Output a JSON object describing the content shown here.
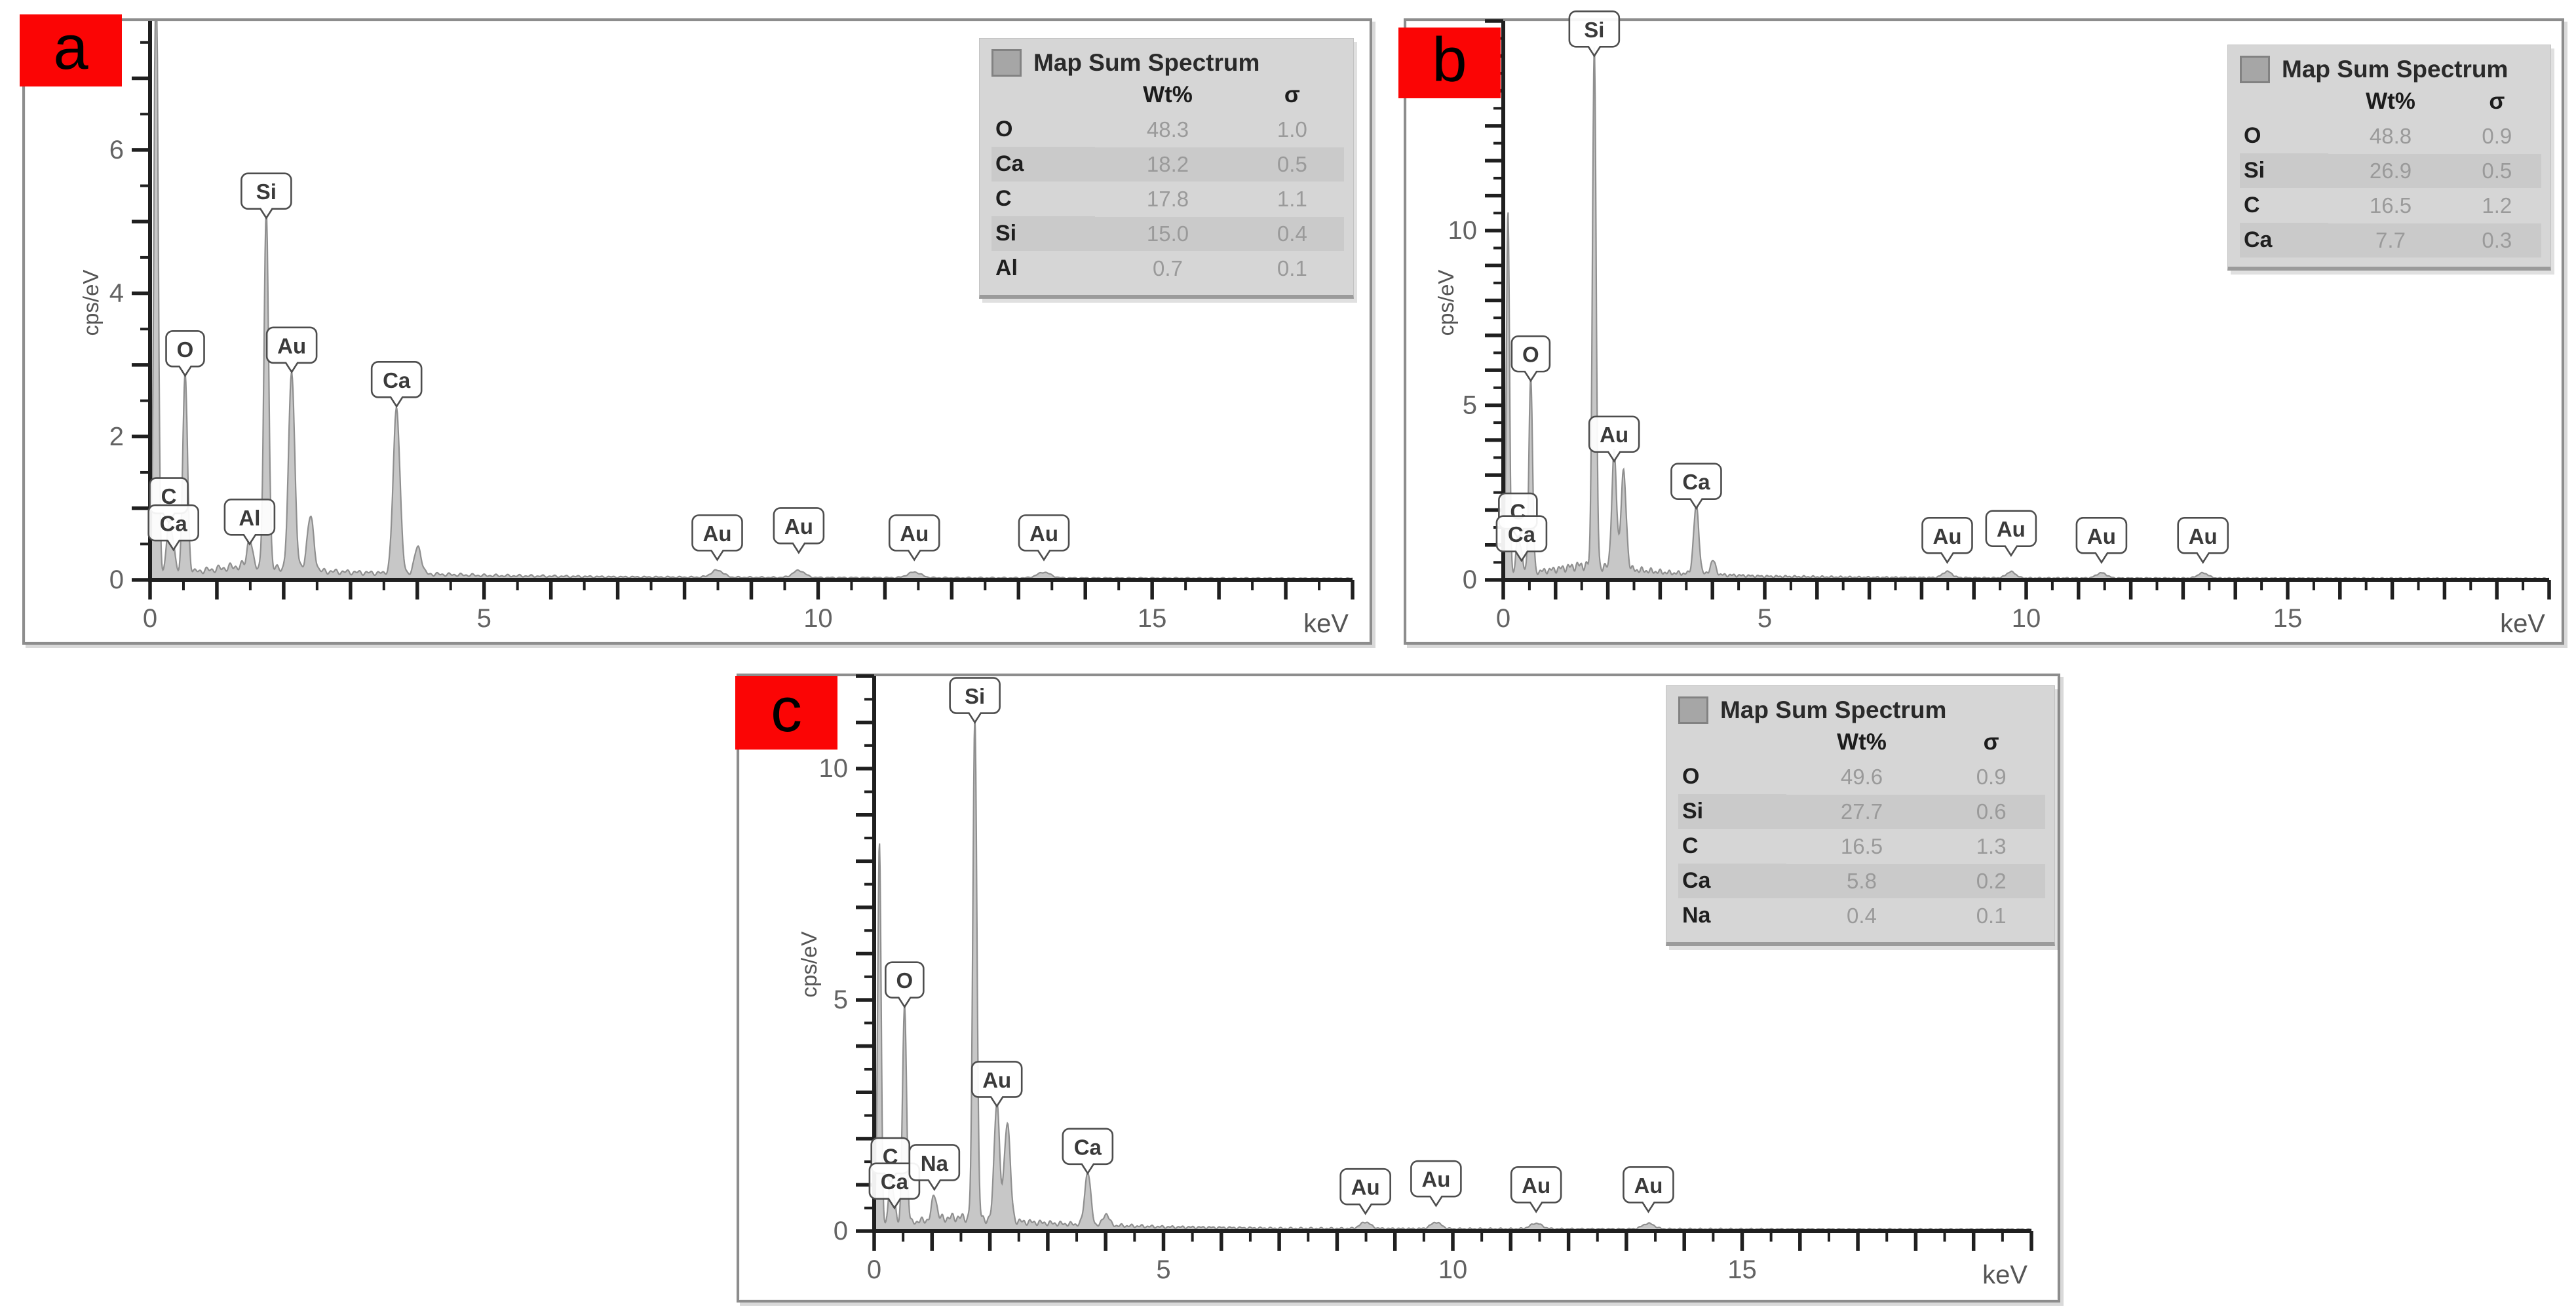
{
  "figure": {
    "badge_color": "#fb0505",
    "panel_border_color": "#8d8d8d",
    "spectrum_fill": "#c7c7c7",
    "spectrum_stroke": "#8f8f8f",
    "axis_color": "#1f1f1f",
    "legend_bg": "#d6d6d6"
  },
  "chart_data": [
    {
      "type": "area",
      "panel_label": "a",
      "xlabel": "keV",
      "ylabel": "cps/eV",
      "xlim": [
        0,
        18
      ],
      "ylim": [
        0,
        7.8
      ],
      "x_major_labels": [
        0,
        5,
        10,
        15
      ],
      "y_major_labels": [
        0,
        2,
        4,
        6
      ],
      "minor_step": 0.5,
      "grid": false,
      "legend_position": "top-right",
      "legend": {
        "title": "Map Sum Spectrum",
        "columns": [
          "Wt%",
          "σ"
        ],
        "rows": [
          {
            "element": "O",
            "wt": "48.3",
            "sigma": "1.0"
          },
          {
            "element": "Ca",
            "wt": "18.2",
            "sigma": "0.5"
          },
          {
            "element": "C",
            "wt": "17.8",
            "sigma": "1.1"
          },
          {
            "element": "Si",
            "wt": "15.0",
            "sigma": "0.4"
          },
          {
            "element": "Al",
            "wt": "0.7",
            "sigma": "0.1"
          }
        ]
      },
      "peaks": [
        {
          "element": "zero-peak",
          "kev": 0.09,
          "height": 9.0,
          "sigma": 0.03
        },
        {
          "element": "C",
          "kev": 0.28,
          "height": 0.72,
          "sigma": 0.035
        },
        {
          "element": "Ca",
          "kev": 0.35,
          "height": 0.35,
          "sigma": 0.03
        },
        {
          "element": "O",
          "kev": 0.525,
          "height": 2.78,
          "sigma": 0.035
        },
        {
          "element": "Al",
          "kev": 1.49,
          "height": 0.42,
          "sigma": 0.035
        },
        {
          "element": "Si",
          "kev": 1.74,
          "height": 4.95,
          "sigma": 0.035
        },
        {
          "element": "Au",
          "kev": 2.12,
          "height": 2.78,
          "sigma": 0.045
        },
        {
          "element": "Au",
          "kev": 2.4,
          "height": 0.75,
          "sigma": 0.05
        },
        {
          "element": "Ca",
          "kev": 3.69,
          "height": 2.32,
          "sigma": 0.05
        },
        {
          "element": "Ca",
          "kev": 4.01,
          "height": 0.38,
          "sigma": 0.05
        },
        {
          "element": "Au",
          "kev": 8.49,
          "height": 0.1,
          "sigma": 0.09
        },
        {
          "element": "Au",
          "kev": 9.71,
          "height": 0.1,
          "sigma": 0.09
        },
        {
          "element": "Au",
          "kev": 11.44,
          "height": 0.08,
          "sigma": 0.1
        },
        {
          "element": "Au",
          "kev": 13.38,
          "height": 0.08,
          "sigma": 0.1
        }
      ],
      "annotations": [
        {
          "text": "C",
          "kev": 0.28,
          "y": 0.8
        },
        {
          "text": "Ca",
          "kev": 0.35,
          "y": 0.42
        },
        {
          "text": "O",
          "kev": 0.525,
          "y": 2.85
        },
        {
          "text": "Al",
          "kev": 1.49,
          "y": 0.5
        },
        {
          "text": "Si",
          "kev": 1.74,
          "y": 5.05
        },
        {
          "text": "Au",
          "kev": 2.12,
          "y": 2.9
        },
        {
          "text": "Ca",
          "kev": 3.69,
          "y": 2.42
        },
        {
          "text": "Au",
          "kev": 8.49,
          "y": 0.28
        },
        {
          "text": "Au",
          "kev": 9.71,
          "y": 0.38
        },
        {
          "text": "Au",
          "kev": 11.44,
          "y": 0.28
        },
        {
          "text": "Au",
          "kev": 13.38,
          "y": 0.28
        }
      ],
      "background": [
        [
          0,
          0.06
        ],
        [
          0.5,
          0.1
        ],
        [
          0.9,
          0.14
        ],
        [
          1.4,
          0.2
        ],
        [
          1.8,
          0.16
        ],
        [
          2.6,
          0.12
        ],
        [
          3.2,
          0.1
        ],
        [
          4.2,
          0.08
        ],
        [
          5,
          0.06
        ],
        [
          7,
          0.04
        ],
        [
          10,
          0.03
        ],
        [
          18,
          0.02
        ]
      ]
    },
    {
      "type": "area",
      "panel_label": "b",
      "xlabel": "keV",
      "ylabel": "cps/eV",
      "xlim": [
        0,
        20
      ],
      "ylim": [
        0,
        16
      ],
      "x_major_labels": [
        0,
        5,
        10,
        15
      ],
      "y_major_labels": [
        0,
        5,
        10
      ],
      "minor_step": 0.5,
      "grid": false,
      "legend_position": "top-right",
      "legend": {
        "title": "Map Sum Spectrum",
        "columns": [
          "Wt%",
          "σ"
        ],
        "rows": [
          {
            "element": "O",
            "wt": "48.8",
            "sigma": "0.9"
          },
          {
            "element": "Si",
            "wt": "26.9",
            "sigma": "0.5"
          },
          {
            "element": "C",
            "wt": "16.5",
            "sigma": "1.2"
          },
          {
            "element": "Ca",
            "wt": "7.7",
            "sigma": "0.3"
          }
        ]
      },
      "peaks": [
        {
          "element": "zero-peak",
          "kev": 0.09,
          "height": 10.4,
          "sigma": 0.03
        },
        {
          "element": "C",
          "kev": 0.28,
          "height": 1.1,
          "sigma": 0.035
        },
        {
          "element": "Ca",
          "kev": 0.35,
          "height": 0.5,
          "sigma": 0.03
        },
        {
          "element": "O",
          "kev": 0.525,
          "height": 5.6,
          "sigma": 0.035
        },
        {
          "element": "Si",
          "kev": 1.74,
          "height": 14.9,
          "sigma": 0.035
        },
        {
          "element": "Au",
          "kev": 2.12,
          "height": 3.3,
          "sigma": 0.045
        },
        {
          "element": "Au",
          "kev": 2.3,
          "height": 2.75,
          "sigma": 0.05
        },
        {
          "element": "Ca",
          "kev": 3.69,
          "height": 1.95,
          "sigma": 0.05
        },
        {
          "element": "Ca",
          "kev": 4.01,
          "height": 0.4,
          "sigma": 0.05
        },
        {
          "element": "Au",
          "kev": 8.49,
          "height": 0.18,
          "sigma": 0.09
        },
        {
          "element": "Au",
          "kev": 9.71,
          "height": 0.18,
          "sigma": 0.09
        },
        {
          "element": "Au",
          "kev": 11.44,
          "height": 0.15,
          "sigma": 0.1
        },
        {
          "element": "Au",
          "kev": 13.38,
          "height": 0.15,
          "sigma": 0.1
        }
      ],
      "annotations": [
        {
          "text": "C",
          "kev": 0.28,
          "y": 1.2
        },
        {
          "text": "Ca",
          "kev": 0.35,
          "y": 0.55
        },
        {
          "text": "O",
          "kev": 0.525,
          "y": 5.7
        },
        {
          "text": "Si",
          "kev": 1.74,
          "y": 15.0
        },
        {
          "text": "Au",
          "kev": 2.12,
          "y": 3.4
        },
        {
          "text": "Ca",
          "kev": 3.69,
          "y": 2.05
        },
        {
          "text": "Au",
          "kev": 8.49,
          "y": 0.5
        },
        {
          "text": "Au",
          "kev": 9.71,
          "y": 0.7
        },
        {
          "text": "Au",
          "kev": 11.44,
          "y": 0.5
        },
        {
          "text": "Au",
          "kev": 13.38,
          "y": 0.5
        }
      ],
      "background": [
        [
          0,
          0.12
        ],
        [
          0.5,
          0.2
        ],
        [
          1,
          0.3
        ],
        [
          1.5,
          0.42
        ],
        [
          2,
          0.35
        ],
        [
          2.6,
          0.28
        ],
        [
          3.2,
          0.2
        ],
        [
          4.2,
          0.14
        ],
        [
          5,
          0.1
        ],
        [
          7,
          0.07
        ],
        [
          10,
          0.05
        ],
        [
          20,
          0.04
        ]
      ]
    },
    {
      "type": "area",
      "panel_label": "c",
      "xlabel": "keV",
      "ylabel": "cps/eV",
      "xlim": [
        0,
        20
      ],
      "ylim": [
        0,
        12
      ],
      "x_major_labels": [
        0,
        5,
        10,
        15
      ],
      "y_major_labels": [
        0,
        5,
        10
      ],
      "minor_step": 0.5,
      "grid": false,
      "legend_position": "top-right",
      "legend": {
        "title": "Map Sum Spectrum",
        "columns": [
          "Wt%",
          "σ"
        ],
        "rows": [
          {
            "element": "O",
            "wt": "49.6",
            "sigma": "0.9"
          },
          {
            "element": "Si",
            "wt": "27.7",
            "sigma": "0.6"
          },
          {
            "element": "C",
            "wt": "16.5",
            "sigma": "1.3"
          },
          {
            "element": "Ca",
            "wt": "5.8",
            "sigma": "0.2"
          },
          {
            "element": "Na",
            "wt": "0.4",
            "sigma": "0.1"
          }
        ]
      },
      "peaks": [
        {
          "element": "zero-peak",
          "kev": 0.09,
          "height": 8.3,
          "sigma": 0.03
        },
        {
          "element": "C",
          "kev": 0.28,
          "height": 0.95,
          "sigma": 0.035
        },
        {
          "element": "Ca",
          "kev": 0.35,
          "height": 0.45,
          "sigma": 0.03
        },
        {
          "element": "O",
          "kev": 0.525,
          "height": 4.75,
          "sigma": 0.035
        },
        {
          "element": "Na",
          "kev": 1.04,
          "height": 0.55,
          "sigma": 0.04
        },
        {
          "element": "Si",
          "kev": 1.74,
          "height": 10.9,
          "sigma": 0.035
        },
        {
          "element": "Au",
          "kev": 2.12,
          "height": 2.6,
          "sigma": 0.045
        },
        {
          "element": "Au",
          "kev": 2.3,
          "height": 2.15,
          "sigma": 0.05
        },
        {
          "element": "Ca",
          "kev": 3.69,
          "height": 1.15,
          "sigma": 0.05
        },
        {
          "element": "Ca",
          "kev": 4.01,
          "height": 0.25,
          "sigma": 0.05
        },
        {
          "element": "Au",
          "kev": 8.49,
          "height": 0.14,
          "sigma": 0.09
        },
        {
          "element": "Au",
          "kev": 9.71,
          "height": 0.14,
          "sigma": 0.09
        },
        {
          "element": "Au",
          "kev": 11.44,
          "height": 0.12,
          "sigma": 0.1
        },
        {
          "element": "Au",
          "kev": 13.38,
          "height": 0.12,
          "sigma": 0.1
        }
      ],
      "annotations": [
        {
          "text": "C",
          "kev": 0.28,
          "y": 1.05
        },
        {
          "text": "Ca",
          "kev": 0.35,
          "y": 0.5
        },
        {
          "text": "O",
          "kev": 0.525,
          "y": 4.85
        },
        {
          "text": "Na",
          "kev": 1.04,
          "y": 0.9
        },
        {
          "text": "Si",
          "kev": 1.74,
          "y": 11.0
        },
        {
          "text": "Au",
          "kev": 2.12,
          "y": 2.7
        },
        {
          "text": "Ca",
          "kev": 3.69,
          "y": 1.25
        },
        {
          "text": "Au",
          "kev": 8.49,
          "y": 0.38
        },
        {
          "text": "Au",
          "kev": 9.71,
          "y": 0.55
        },
        {
          "text": "Au",
          "kev": 11.44,
          "y": 0.42
        },
        {
          "text": "Au",
          "kev": 13.38,
          "y": 0.42
        }
      ],
      "background": [
        [
          0,
          0.1
        ],
        [
          0.5,
          0.16
        ],
        [
          0.9,
          0.24
        ],
        [
          1.4,
          0.3
        ],
        [
          1.9,
          0.26
        ],
        [
          2.6,
          0.2
        ],
        [
          3.2,
          0.16
        ],
        [
          4.2,
          0.12
        ],
        [
          5,
          0.09
        ],
        [
          7,
          0.06
        ],
        [
          10,
          0.05
        ],
        [
          20,
          0.04
        ]
      ]
    }
  ]
}
